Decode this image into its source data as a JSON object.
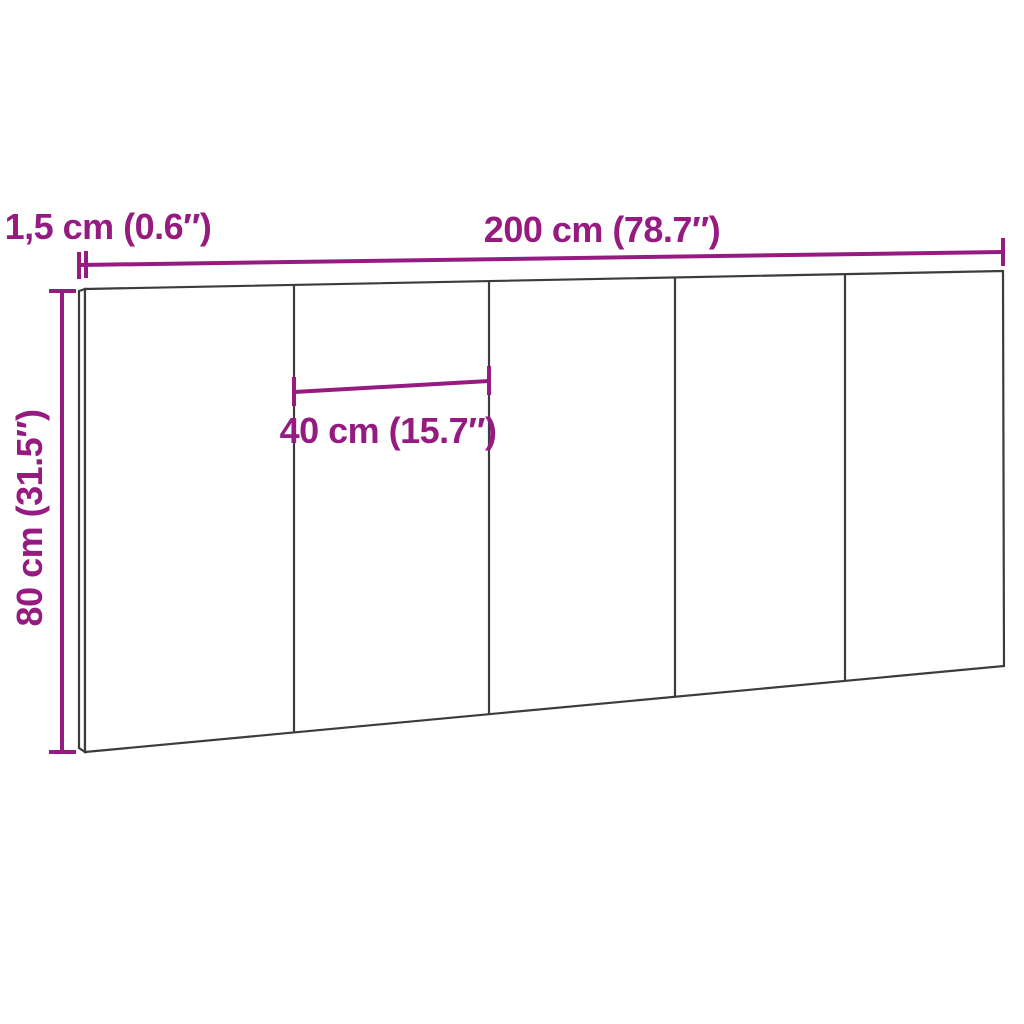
{
  "diagram": {
    "type": "product-dimension-diagram",
    "background_color": "#ffffff",
    "outline_color": "#3c3c3b",
    "dimension_color": "#951b81",
    "panel_count": 5,
    "dimensions": {
      "width": {
        "cm": 200,
        "inches": 78.7,
        "label": "200 cm (78.7″)"
      },
      "height": {
        "cm": 80,
        "inches": 31.5,
        "label": "80 cm (31.5″)"
      },
      "thickness": {
        "cm": 1.5,
        "inches": 0.6,
        "label": "1,5 cm (0.6″)"
      },
      "panel_width": {
        "cm": 40,
        "inches": 15.7,
        "label": "40 cm (15.7″)"
      }
    }
  }
}
